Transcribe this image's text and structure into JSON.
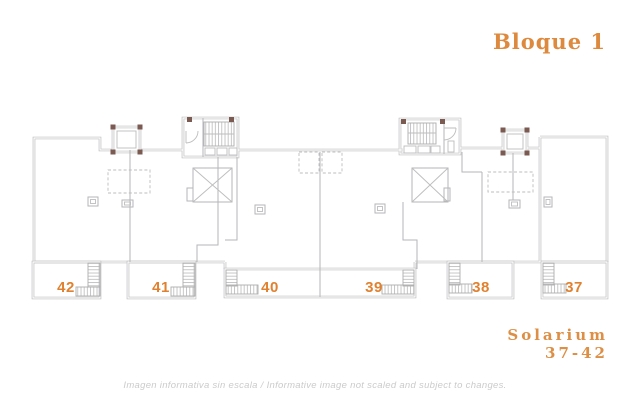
{
  "page": {
    "title": "Bloque 1",
    "solarium_label": "Solarium",
    "solarium_range": "37-42",
    "disclaimer": "Imagen informativa sin escala / Informative image not scaled and subject to changes."
  },
  "floor_plan": {
    "block": "Bloque 1",
    "level": "Solarium",
    "units": [
      {
        "number": "42"
      },
      {
        "number": "41"
      },
      {
        "number": "40"
      },
      {
        "number": "39"
      },
      {
        "number": "38"
      },
      {
        "number": "37"
      }
    ]
  },
  "colors": {
    "accent_orange": "#e0812f",
    "title_orange": "#de8a3e",
    "plan_line_gray": "#b2b2b4",
    "corner_mark_brown": "#7b5a52",
    "disclaimer_gray": "#cbcbcb"
  }
}
